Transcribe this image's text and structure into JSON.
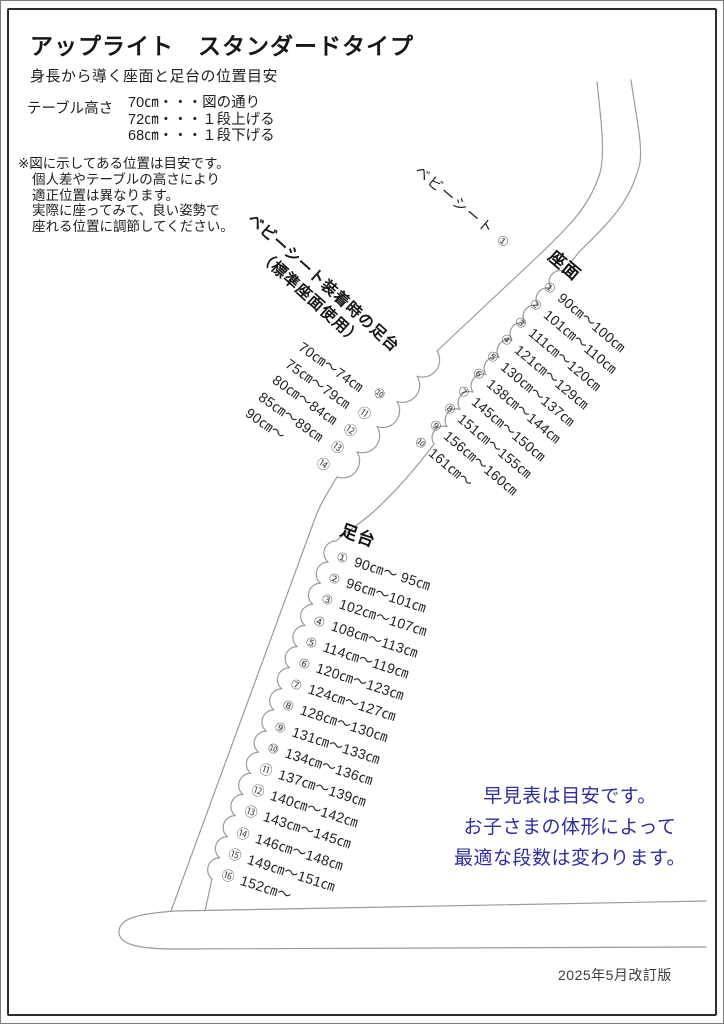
{
  "page": {
    "title": "アップライト　スタンダードタイプ",
    "subtitle": "身長から導く座面と足台の位置目安",
    "footer": "2025年5月改訂版"
  },
  "table_height": {
    "label": "テーブル高さ",
    "rows": [
      {
        "text": "70㎝・・・図の通り"
      },
      {
        "text": "72㎝・・・１段上げる"
      },
      {
        "text": "68㎝・・・１段下げる"
      }
    ]
  },
  "notes": {
    "lines": [
      {
        "text": "※図に示してある位置は目安です。"
      },
      {
        "text": "個人差やテーブルの高さにより"
      },
      {
        "text": "適正位置は異なります。"
      },
      {
        "text": "実際に座ってみて、良い姿勢で"
      },
      {
        "text": "座れる位置に調節してください。"
      }
    ]
  },
  "baby_seat": {
    "label": "ベビーシート",
    "num": "①"
  },
  "seat": {
    "title": "座面",
    "items": [
      {
        "num": "①",
        "range": "90㎝〜100㎝"
      },
      {
        "num": "②",
        "range": "101㎝〜110㎝"
      },
      {
        "num": "③",
        "range": "111㎝〜120㎝"
      },
      {
        "num": "④",
        "range": "121㎝〜129㎝"
      },
      {
        "num": "⑤",
        "range": "130㎝〜137㎝"
      },
      {
        "num": "⑥",
        "range": "138㎝〜144㎝"
      },
      {
        "num": "⑦",
        "range": "145㎝〜150㎝"
      },
      {
        "num": "⑧",
        "range": "151㎝〜155㎝"
      },
      {
        "num": "⑨",
        "range": "156㎝〜160㎝"
      },
      {
        "num": "⑩",
        "range": "161㎝〜"
      }
    ]
  },
  "baby_footrest": {
    "label_line1": "ベビーシート装着時の足台",
    "label_line2": "（標準座面使用）",
    "items": [
      {
        "num": "⑩",
        "range": "70㎝〜74㎝"
      },
      {
        "num": "⑪",
        "range": "75㎝〜79㎝"
      },
      {
        "num": "⑫",
        "range": "80㎝〜84㎝"
      },
      {
        "num": "⑬",
        "range": "85㎝〜89㎝"
      },
      {
        "num": "⑭",
        "range": "90㎝〜"
      }
    ]
  },
  "footrest": {
    "title": "足台",
    "items": [
      {
        "num": "①",
        "range": "90㎝〜 95㎝"
      },
      {
        "num": "②",
        "range": "96㎝〜101㎝"
      },
      {
        "num": "③",
        "range": "102㎝〜107㎝"
      },
      {
        "num": "④",
        "range": "108㎝〜113㎝"
      },
      {
        "num": "⑤",
        "range": "114㎝〜119㎝"
      },
      {
        "num": "⑥",
        "range": "120㎝〜123㎝"
      },
      {
        "num": "⑦",
        "range": "124㎝〜127㎝"
      },
      {
        "num": "⑧",
        "range": "128㎝〜130㎝"
      },
      {
        "num": "⑨",
        "range": "131㎝〜133㎝"
      },
      {
        "num": "⑩",
        "range": "134㎝〜136㎝"
      },
      {
        "num": "⑪",
        "range": "137㎝〜139㎝"
      },
      {
        "num": "⑫",
        "range": "140㎝〜142㎝"
      },
      {
        "num": "⑬",
        "range": "143㎝〜145㎝"
      },
      {
        "num": "⑭",
        "range": "146㎝〜148㎝"
      },
      {
        "num": "⑮",
        "range": "149㎝〜151㎝"
      },
      {
        "num": "⑯",
        "range": "152㎝〜"
      }
    ]
  },
  "notice": {
    "color": "#2e2e9e",
    "lines": [
      {
        "text": "早見表は目安です。"
      },
      {
        "text": "お子さまの体形によって"
      },
      {
        "text": "最適な段数は変わります。"
      }
    ]
  },
  "colors": {
    "line": "#9b9b9b",
    "frame": "#2c2c2c"
  }
}
